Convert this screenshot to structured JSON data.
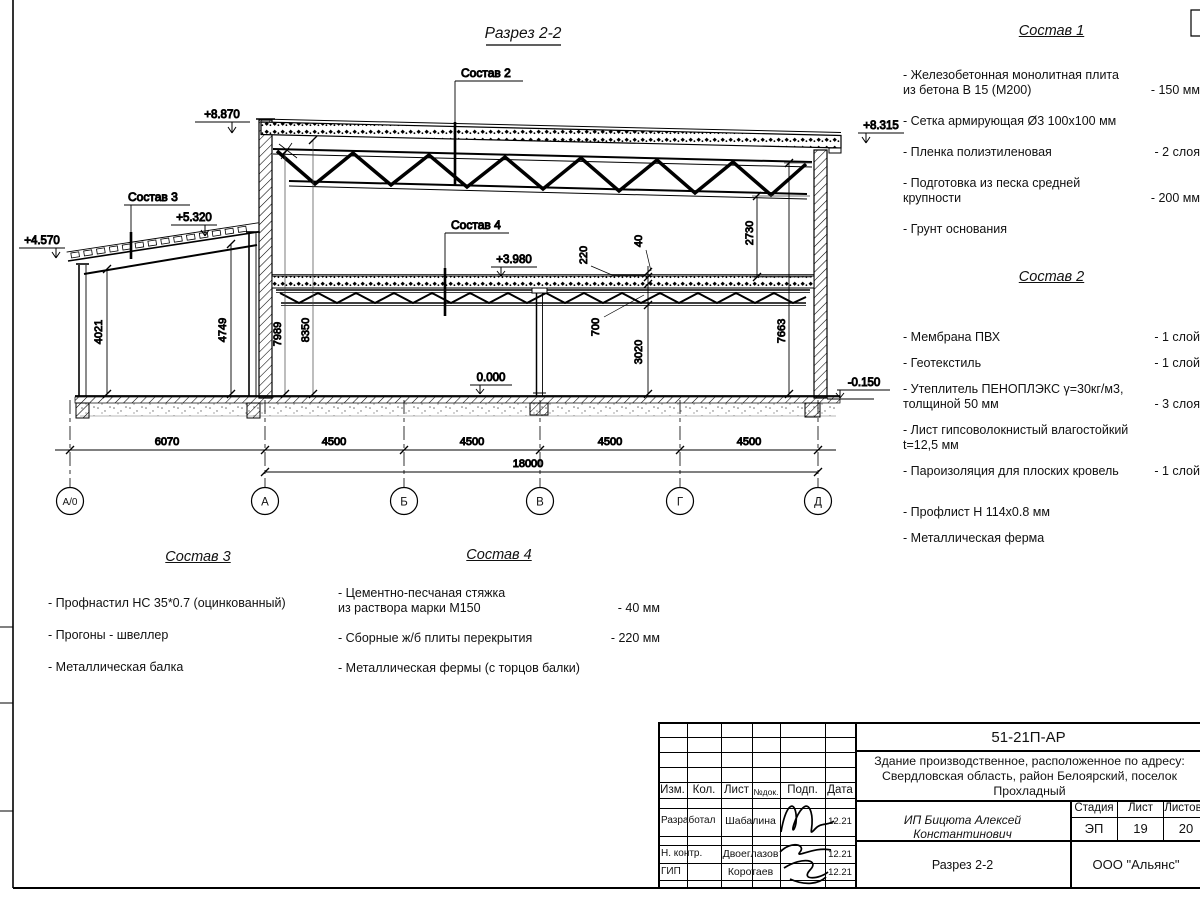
{
  "sheet": {
    "title": "Разрез 2-2"
  },
  "elevations": {
    "top_left": "+8.870",
    "top_right": "+8.315",
    "annex_left": "+4.570",
    "annex_right": "+5.320",
    "mezzanine": "+3.980",
    "floor": "0.000",
    "ground": "-0.150"
  },
  "dimensions": {
    "v4021": "4021",
    "v4749": "4749",
    "v7989": "7989",
    "v8350": "8350",
    "v220": "220",
    "v40": "40",
    "v700": "700",
    "v3020": "3020",
    "v2730": "2730",
    "v7663": "7663",
    "h6070": "6070",
    "h4500": "4500",
    "h18000": "18000"
  },
  "axes": {
    "a0": "А/0",
    "a": "А",
    "b": "Б",
    "v": "В",
    "g": "Г",
    "d": "Д"
  },
  "callouts": {
    "c2": "Состав 2",
    "c3": "Состав 3",
    "c4": "Состав 4"
  },
  "lists": {
    "s1": {
      "title": "Состав 1",
      "items": [
        {
          "text": "- Железобетонная  монолитная плита\nиз бетона В 15 (М200)",
          "value": "- 150 мм"
        },
        {
          "text": "- Сетка армирующая Ø3 100х100 мм",
          "value": ""
        },
        {
          "text": "- Пленка полиэтиленовая",
          "value": "- 2 слоя"
        },
        {
          "text": "- Подготовка из песка средней\nкрупности",
          "value": "- 200 мм"
        },
        {
          "text": "- Грунт основания",
          "value": ""
        }
      ]
    },
    "s2": {
      "title": "Состав 2",
      "items": [
        {
          "text": "- Мембрана ПВХ",
          "value": "- 1 слой"
        },
        {
          "text": "- Геотекстиль",
          "value": "- 1 слой"
        },
        {
          "text": "- Утеплитель ПЕНОПЛЭКС γ=30кг/м3,\nтолщиной 50 мм",
          "value": "- 3 слоя"
        },
        {
          "text": "- Лист гипсоволокнистый влагостойкий\nt=12,5 мм",
          "value": ""
        },
        {
          "text": "- Пароизоляция для плоских кровель",
          "value": "- 1 слой"
        },
        {
          "text": "- Профлист Н 114х0.8 мм",
          "value": ""
        },
        {
          "text": "- Металлическая ферма",
          "value": ""
        }
      ]
    },
    "s3": {
      "title": "Состав 3",
      "items": [
        {
          "text": "- Профнастил НС 35*0.7 (оцинкованный)",
          "value": ""
        },
        {
          "text": "- Прогоны - швеллер",
          "value": ""
        },
        {
          "text": "- Металлическая балка",
          "value": ""
        }
      ]
    },
    "s4": {
      "title": "Состав 4",
      "items": [
        {
          "text": "- Цементно-песчаная стяжка\nиз раствора марки М150",
          "value": "- 40 мм"
        },
        {
          "text": "- Сборные ж/б плиты перекрытия",
          "value": "- 220 мм"
        },
        {
          "text": "- Металлическая фермы (с торцов балки)",
          "value": ""
        }
      ]
    }
  },
  "titleblock": {
    "doc_number": "51-21П-АР",
    "project_line1": "Здание производственное, расположенное по адресу:",
    "project_line2": "Свердловская область, район Белоярский, поселок",
    "project_line3": "Прохладный",
    "client": "ИП Бицюта Алексей Константинович",
    "sheet_name": "Разрез 2-2",
    "company": "ООО \"Альянс\"",
    "stage_label": "Стадия",
    "sheet_label": "Лист",
    "sheets_label": "Листов",
    "stage": "ЭП",
    "sheet_no": "19",
    "sheets_total": "20",
    "col_izm": "Изм.",
    "col_kol": "Кол.",
    "col_list": "Лист",
    "col_doc": "№док.",
    "col_podp": "Подп.",
    "col_data": "Дата",
    "rows": [
      {
        "role": "Разработал",
        "name": "Шабалина",
        "date": "12.21"
      },
      {
        "role": "Н. контр.",
        "name": "Двоеглазов",
        "date": "12.21"
      },
      {
        "role": "ГИП",
        "name": "Коротаев",
        "date": "12.21"
      }
    ]
  }
}
